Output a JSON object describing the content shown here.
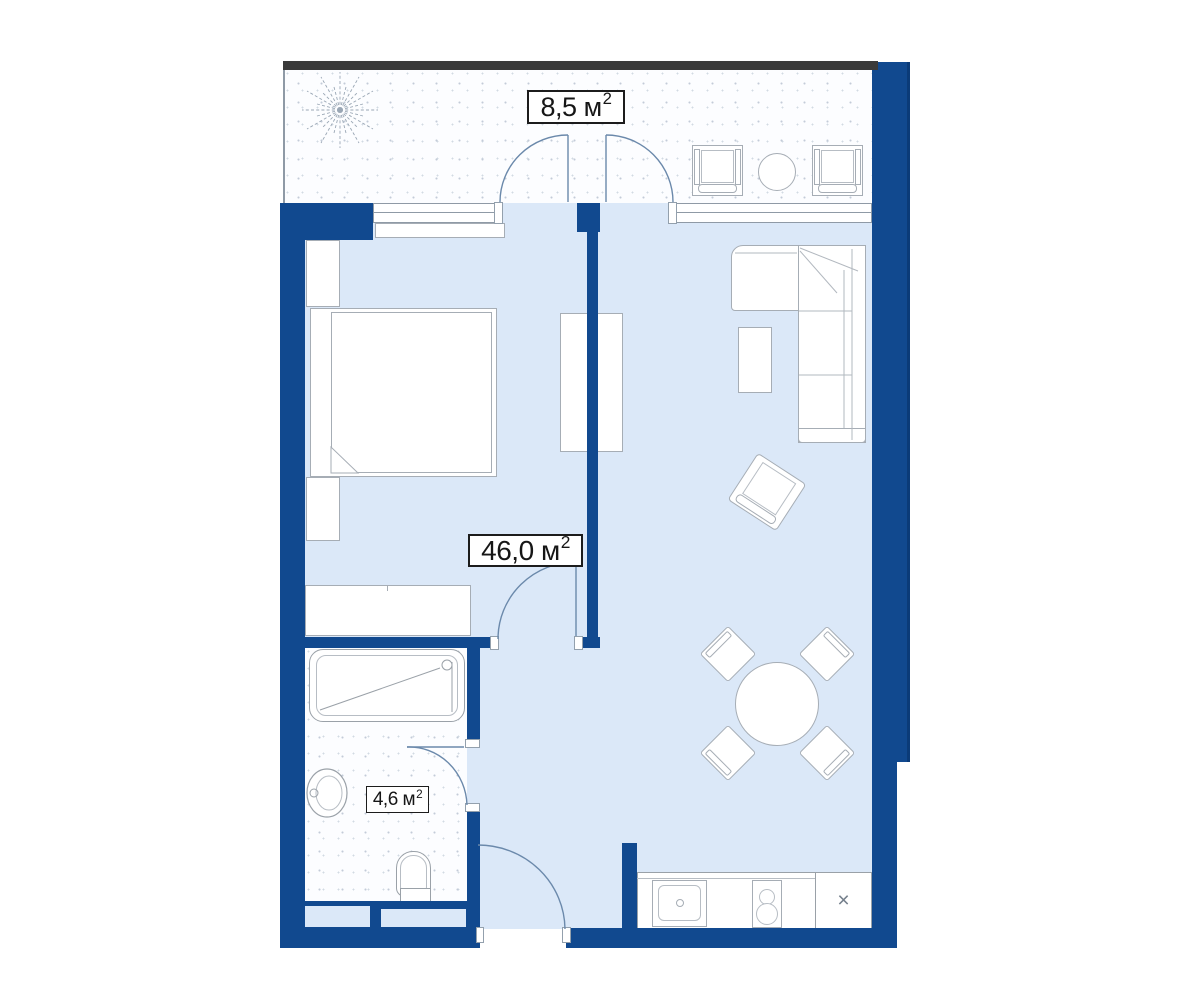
{
  "plan": {
    "labels": {
      "balcony": {
        "value": "8,5",
        "unit": "м",
        "power": "2"
      },
      "apartment": {
        "value": "46,0",
        "unit": "м",
        "power": "2"
      },
      "bathroom": {
        "value": "4,6",
        "unit": "м",
        "power": "2"
      }
    },
    "kitchen": {
      "fridge_mark": "×"
    },
    "colors": {
      "wall": "#11498f",
      "interior_floor": "#dbe8f8",
      "balcony_floor": "#fcfdff",
      "stipple_dot": "#c3ccd8",
      "furniture_outline": "#a6adb5",
      "door_arc": "#6b89ab",
      "label_border": "#1c1c1c",
      "balcony_edge_bar": "#3a3a3a",
      "fridge_mark_color": "#75808c"
    }
  }
}
